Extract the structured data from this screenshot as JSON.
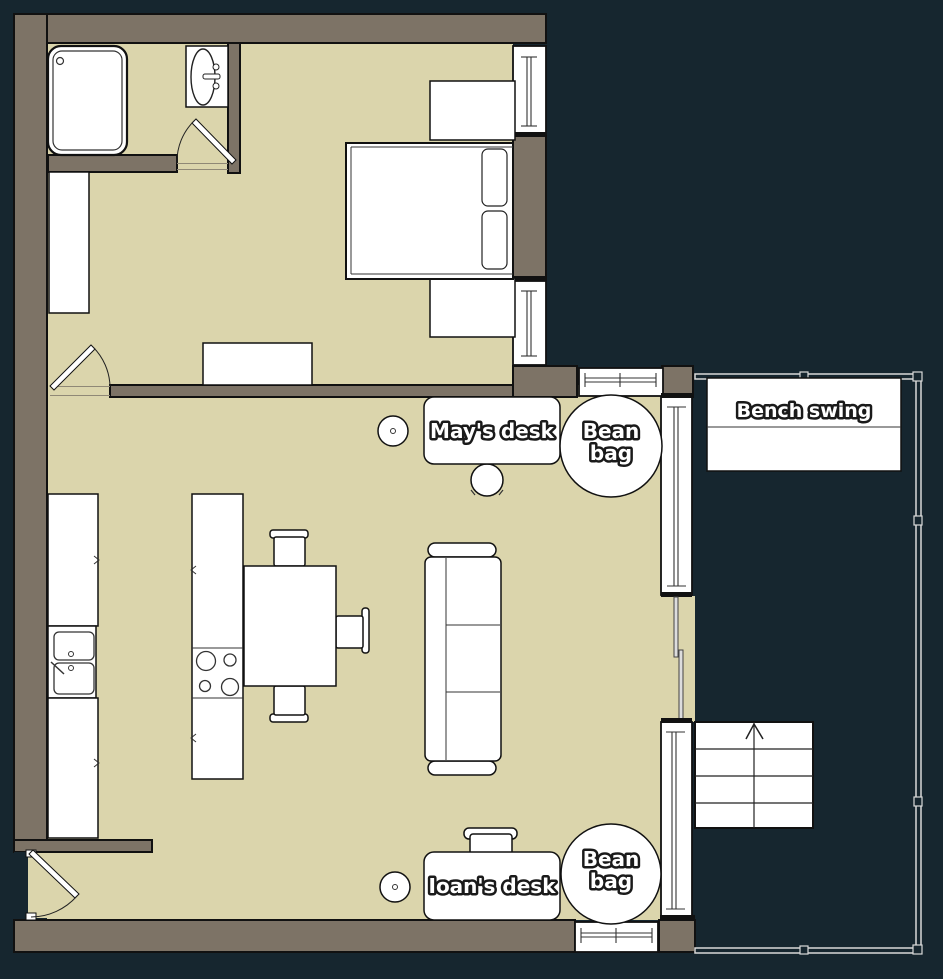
{
  "plan": {
    "title": "apartment-floor-plan",
    "labels": {
      "mays_desk": "May's desk",
      "ioans_desk": "Ioan's desk",
      "bean_bag_line1": "Bean",
      "bean_bag_line2": "bag",
      "bench_swing": "Bench swing"
    },
    "rooms": [
      "bedroom",
      "bathroom",
      "kitchen",
      "living-room",
      "balcony"
    ],
    "furniture": [
      "shower",
      "bathroom-sink",
      "wardrobe",
      "bed",
      "nightstand",
      "dresser",
      "kitchen-counter",
      "kitchen-sink",
      "stove-island",
      "dining-table",
      "chair",
      "sofa",
      "desk",
      "desk-chair",
      "stool",
      "bean-bag",
      "bench-swing",
      "stairs"
    ],
    "colors": {
      "background": "#16262F",
      "wall": "#7D7366",
      "floor": "#DBD5AC",
      "outline": "#111111",
      "furniture": "#FFFFFF",
      "railing": "#D9D9D9"
    }
  }
}
